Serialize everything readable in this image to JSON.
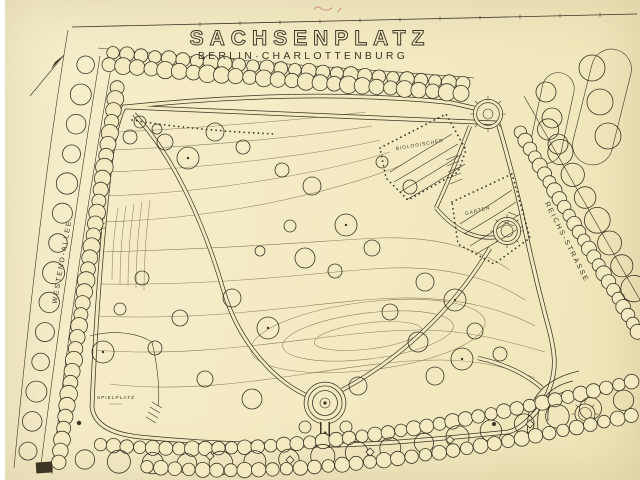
{
  "title": {
    "main": "SACHSENPLATZ",
    "subtitle": "BERLIN·CHARLOTTENBURG"
  },
  "labels": {
    "street_left": "WESTEND-ALLEE",
    "street_right": "REICHS-STRASSE",
    "garden_line1": "BIOLOGISCHER",
    "garden_line2": "GARTEN",
    "playground": "SPIELPLATZ"
  },
  "palette": {
    "paper": "#f4eac2",
    "ink": "#3c3424",
    "contour": "#8b7f5c",
    "annotation": "#c9857a"
  }
}
